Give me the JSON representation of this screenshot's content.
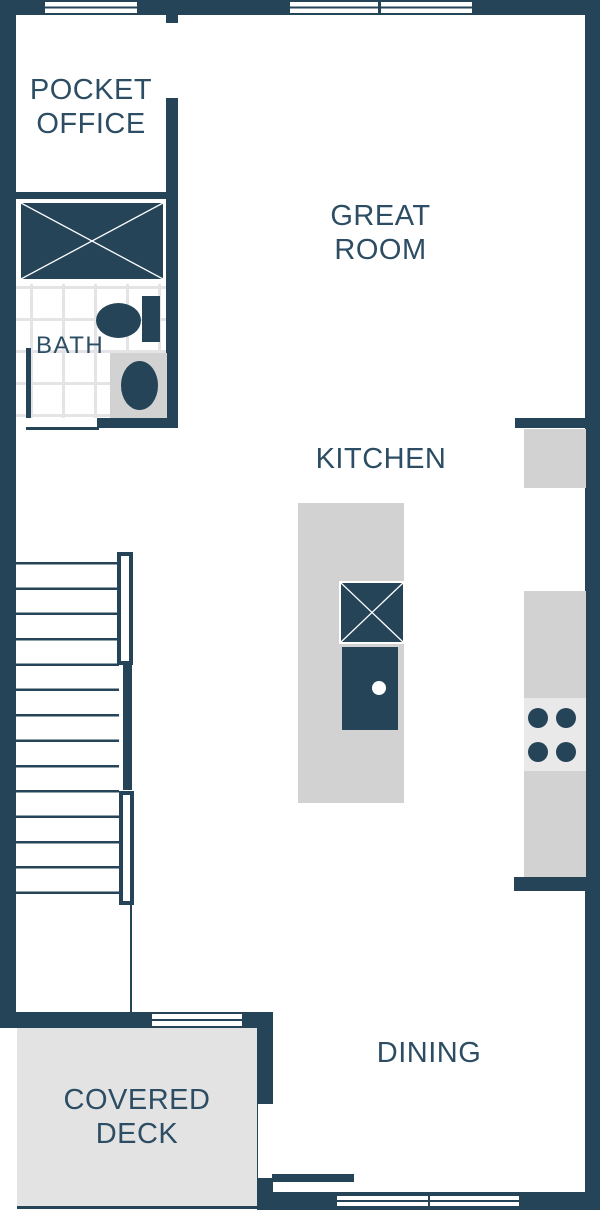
{
  "rooms": {
    "pocket_office": {
      "line1": "POCKET",
      "line2": "OFFICE"
    },
    "great_room": {
      "line1": "GREAT",
      "line2": "ROOM"
    },
    "bath": {
      "label": "BATH"
    },
    "kitchen": {
      "label": "KITCHEN"
    },
    "dining": {
      "label": "DINING"
    },
    "covered_deck": {
      "line1": "COVERED",
      "line2": "DECK"
    }
  },
  "colors": {
    "wall": "#264458",
    "label_text": "#2c4d63",
    "counter_gray": "#d2d2d2",
    "appliance_gray": "#e9e9e9",
    "deck_gray": "#e3e3e3",
    "tile_line": "#e4e4e6",
    "background": "#ffffff"
  },
  "fixtures": [
    "shower",
    "toilet",
    "bath-sink",
    "bath-door",
    "stairs",
    "stair-railing",
    "kitchen-island",
    "island-sink",
    "dishwasher",
    "cooktop-burners",
    "counters",
    "windows",
    "covered-deck-floor"
  ]
}
